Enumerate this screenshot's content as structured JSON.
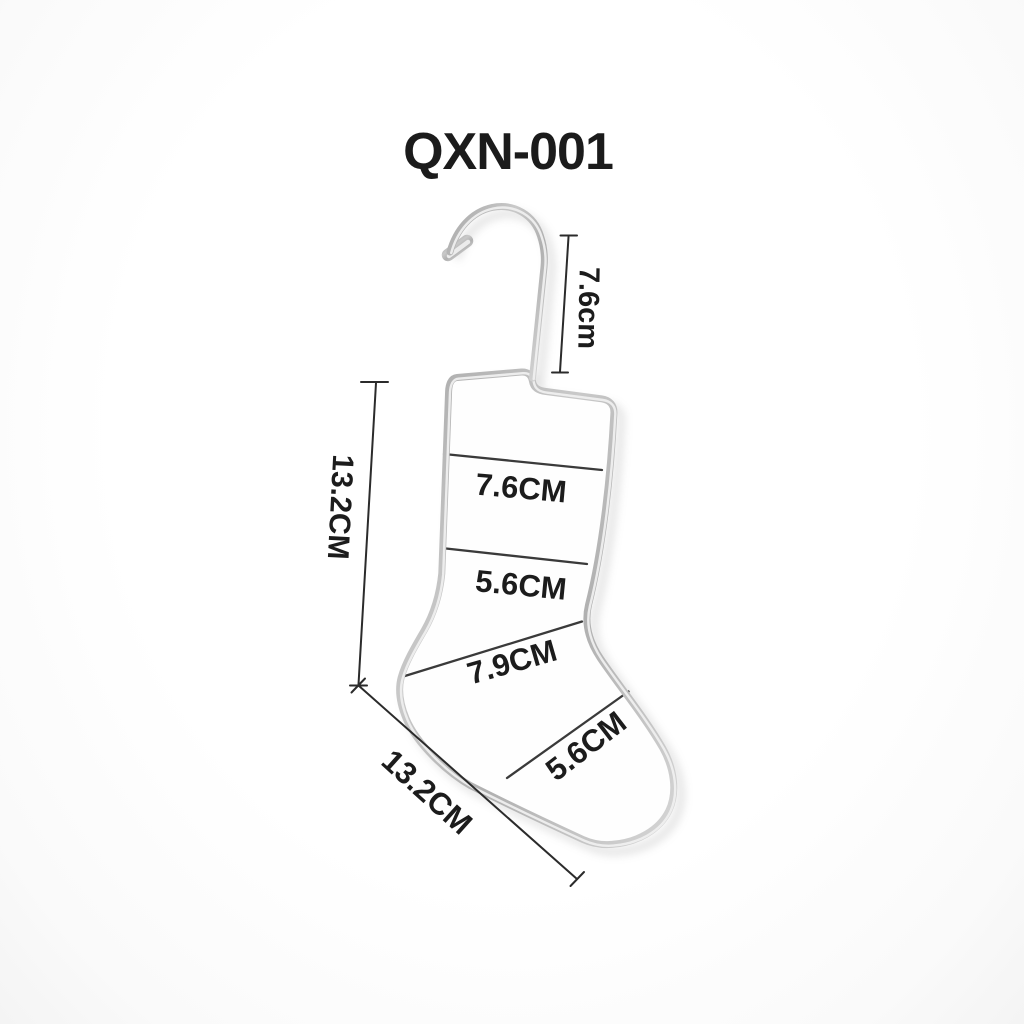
{
  "title": "QXN-001",
  "measurements": {
    "hook_height": "7.6cm",
    "overall_height": "13.2CM",
    "cuff_width": "7.6CM",
    "leg_width": "5.6CM",
    "instep_width": "7.9CM",
    "foot_width": "5.6CM",
    "foot_length": "13.2CM"
  },
  "colors": {
    "background": "#fcfcfc",
    "wire": "#b4b4b4",
    "wire_highlight": "#efefef",
    "dimension_line": "#2b2b2b",
    "divider_line": "#3a3a3a",
    "text": "#1c1c1c"
  }
}
